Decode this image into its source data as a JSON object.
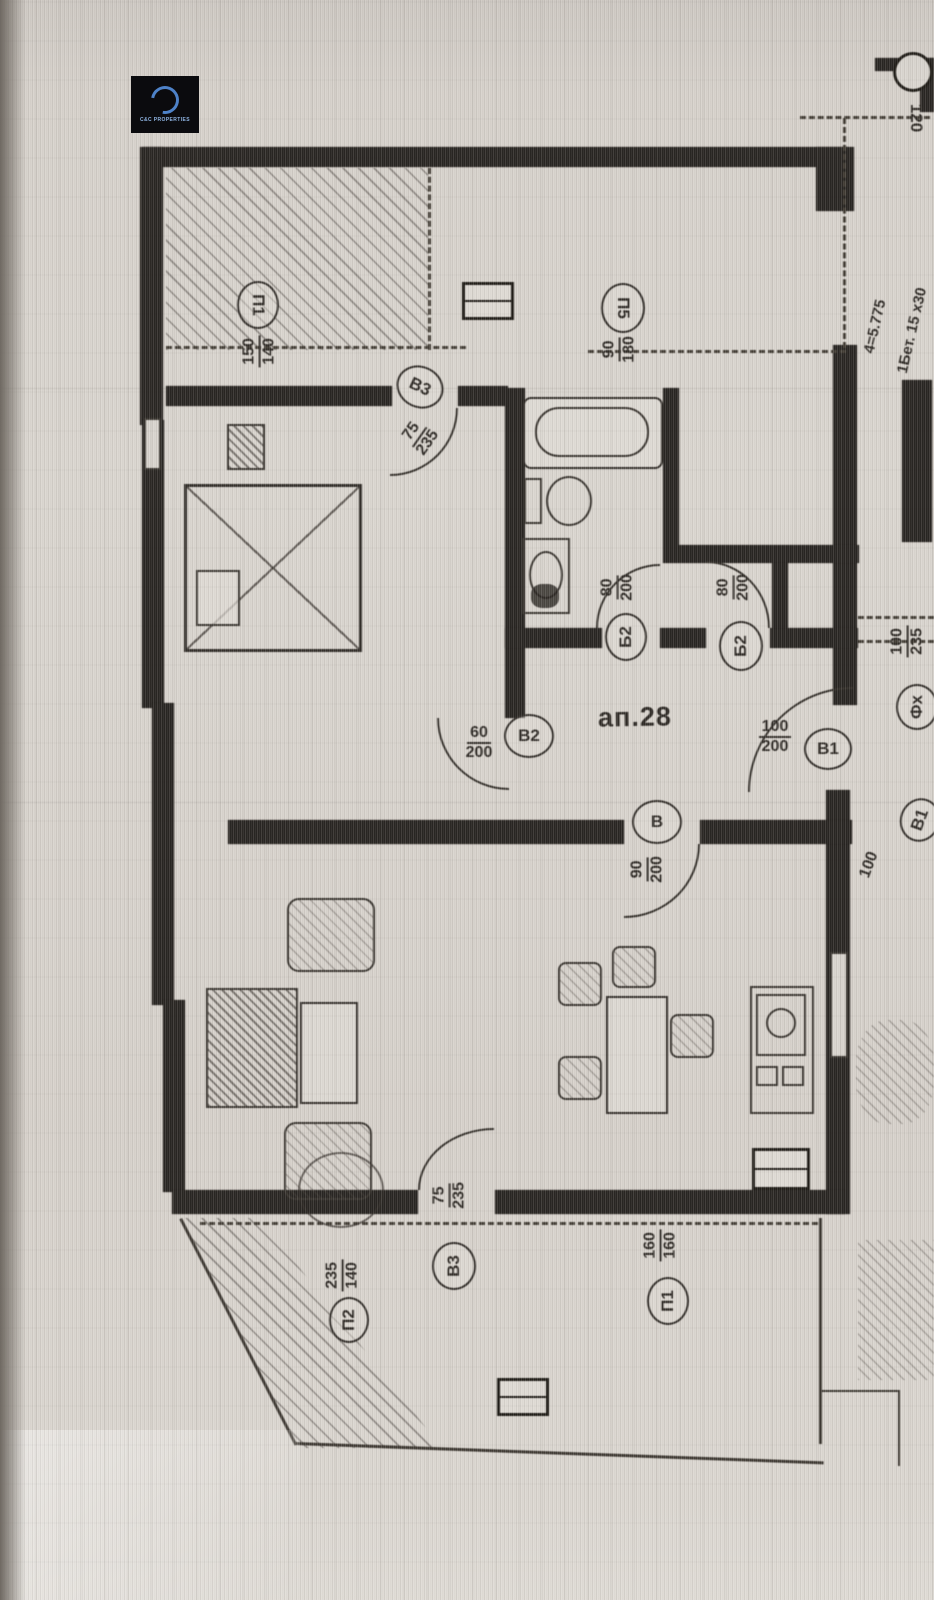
{
  "logo": {
    "text": "C&C PROPERTIES"
  },
  "plan": {
    "apartment_label": "ап.28",
    "dim_top_right": "120",
    "labels": [
      {
        "id": "window-p1-top",
        "circle": "П1",
        "num": "150",
        "den": "140"
      },
      {
        "id": "window-p5",
        "circle": "П5",
        "num": "90",
        "den": "180"
      },
      {
        "id": "door-v3-top",
        "circle": "В3",
        "num": "75",
        "den": "235"
      },
      {
        "id": "door-b2-left",
        "circle": "Б2",
        "num": "80",
        "den": "200"
      },
      {
        "id": "door-b2-right",
        "circle": "Б2",
        "num": "80",
        "den": "200"
      },
      {
        "id": "window-fx",
        "circle": "Фх",
        "num": "100",
        "den": "235"
      },
      {
        "id": "door-v2",
        "circle": "В2",
        "num": "60",
        "den": "200"
      },
      {
        "id": "door-v1-entry",
        "circle": "В1",
        "num": "100",
        "den": "200"
      },
      {
        "id": "door-v",
        "circle": "В",
        "num": "90",
        "den": "200"
      },
      {
        "id": "dim-100-right",
        "circle": "В1",
        "num": "100"
      },
      {
        "id": "door-v3-bottom",
        "circle": "В3",
        "num": "75",
        "den": "235"
      },
      {
        "id": "window-p2-bottom",
        "circle": "П2",
        "num": "235",
        "den": "140"
      },
      {
        "id": "window-p1-bottom",
        "circle": "П1",
        "num": "160",
        "den": "160"
      }
    ],
    "side_notes": [
      "4=5.775",
      "1Бет. 15 х30"
    ]
  }
}
